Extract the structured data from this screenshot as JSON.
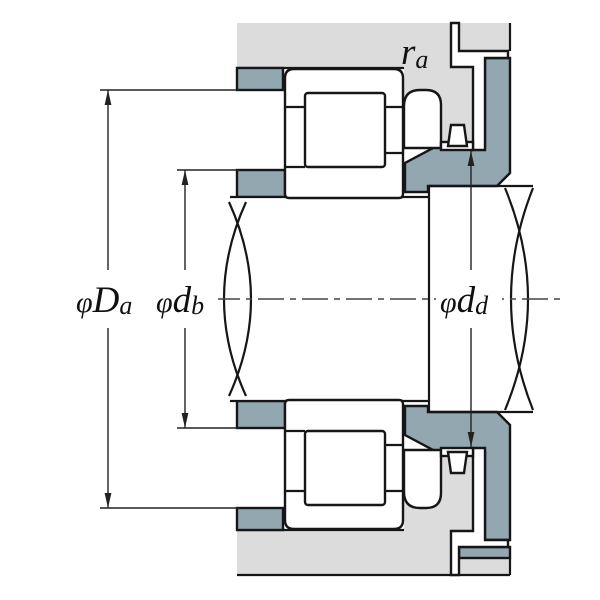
{
  "figure": {
    "type": "bearing-mounting-cross-section",
    "labels": {
      "dim_housing_abutment": {
        "phi": "φ",
        "letter": "D",
        "sub": "a"
      },
      "dim_shaft_abutment": {
        "phi": "φ",
        "letter": "d",
        "sub": "b"
      },
      "dim_collar_abutment": {
        "phi": "φ",
        "letter": "d",
        "sub": "d"
      },
      "fillet_radius": {
        "letter": "r",
        "sub": "a"
      }
    },
    "colors": {
      "housing_gray": "#dcdcdc",
      "abutment_slate": "#93a7b0",
      "outline": "#161616",
      "dimension_line": "#222222",
      "background": "#ffffff"
    }
  }
}
